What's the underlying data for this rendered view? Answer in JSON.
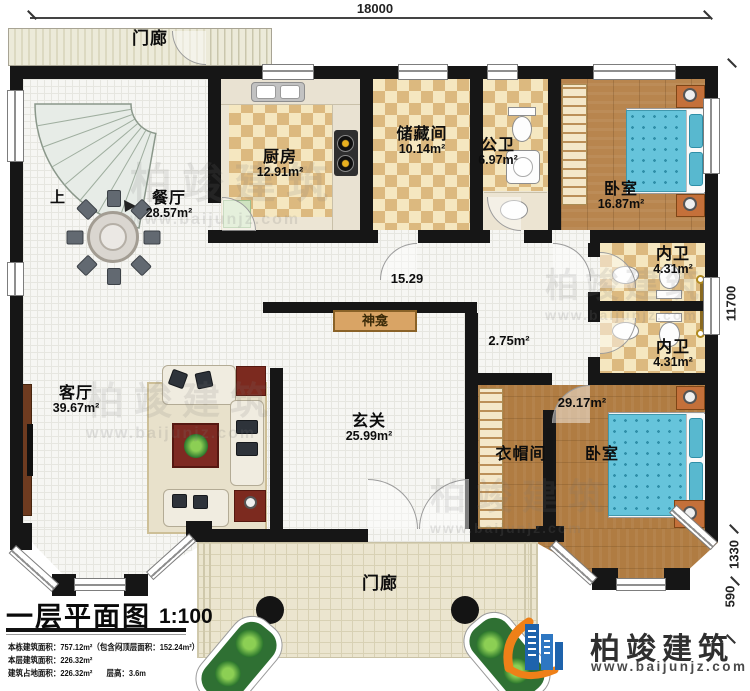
{
  "dims": {
    "top": "18000",
    "right": "11700",
    "bay": "1330",
    "step": "590"
  },
  "rooms": {
    "porch_top": {
      "name": "门廊"
    },
    "stairs": {
      "up": "上"
    },
    "dining": {
      "name": "餐厅",
      "area": "28.57m²"
    },
    "kitchen": {
      "name": "厨房",
      "area": "12.91m²"
    },
    "storage": {
      "name": "储藏间",
      "area": "10.14m²"
    },
    "public_bath": {
      "name": "公卫",
      "area": "6.97m²"
    },
    "bedroom1": {
      "name": "卧室",
      "area": "16.87m²"
    },
    "ensuite1": {
      "name": "内卫",
      "area": "4.31m²"
    },
    "ensuite2": {
      "name": "内卫",
      "area": "4.31m²"
    },
    "living": {
      "name": "客厅",
      "area": "39.67m²"
    },
    "foyer": {
      "name": "玄关",
      "area": "25.99m²"
    },
    "cloakroom": {
      "name": "衣帽间"
    },
    "bedroom2": {
      "name": "卧室",
      "area": "29.17m²"
    },
    "porch_bottom": {
      "name": "门廊"
    },
    "shrine": {
      "name": "神龛"
    }
  },
  "annotations": {
    "hall_length": "15.29",
    "niche_area": "2.75m²"
  },
  "title_block": {
    "title": "一层平面图",
    "scale": "1:100",
    "line1": "本栋建筑面积：757.12m²（包含闷顶层面积：152.24m²）",
    "line2": "本层建筑面积：226.32m²",
    "line3a": "建筑占地面积：226.32m²",
    "line3b": "层高：3.6m"
  },
  "brand": {
    "name": "柏竣建筑",
    "url": "www.baijunjz.com"
  },
  "watermark": {
    "text": "柏竣建筑",
    "url": "www.baijunjz.com"
  }
}
